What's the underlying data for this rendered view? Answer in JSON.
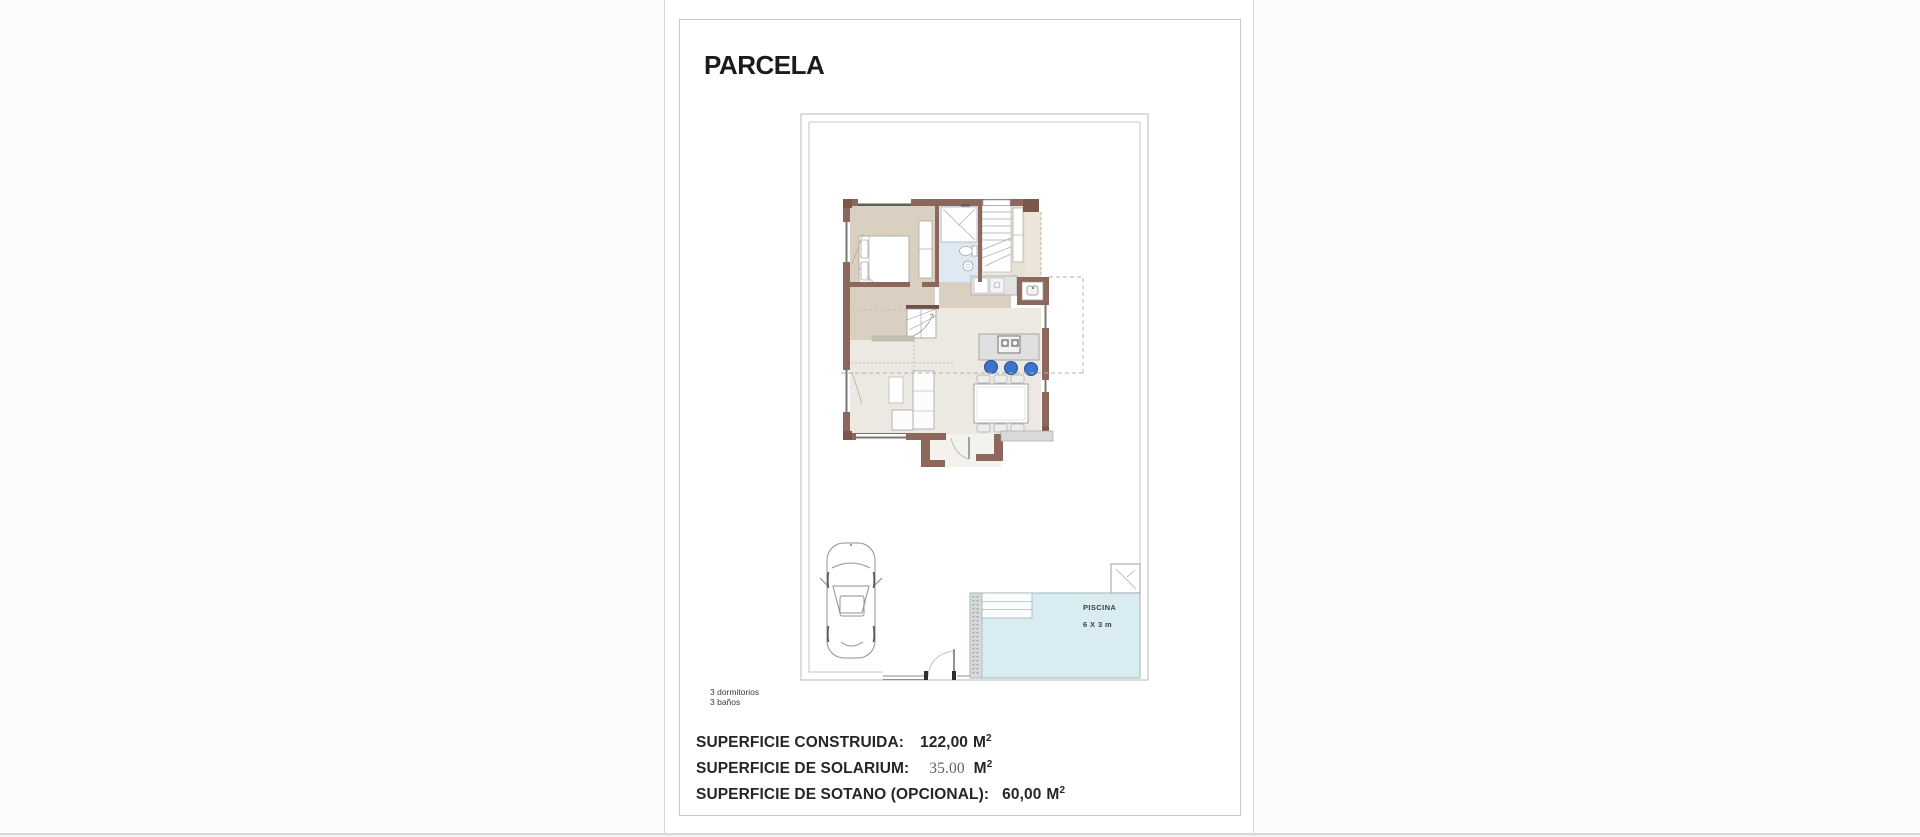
{
  "document": {
    "title": "PARCELA",
    "notes": [
      "3 dormitorios",
      "3 baños"
    ],
    "summary": [
      {
        "label": "SUPERFICIE CONSTRUIDA:",
        "value": "122,00",
        "unit": "M",
        "exp": "2"
      },
      {
        "label": "SUPERFICIE DE SOLARIUM:",
        "value": "35.00",
        "unit": "M",
        "exp": "2"
      },
      {
        "label": "SUPERFICIE DE SOTANO (OPCIONAL):",
        "value": "60,00",
        "unit": "M",
        "exp": "2"
      }
    ],
    "plan": {
      "pool": {
        "label": "PISCINA",
        "size": "6 X 3 m"
      }
    },
    "colors": {
      "wall_brown": "#8d675b",
      "wall_dark": "#7a584c",
      "floor_beige": "#d9d0c2",
      "floor_light": "#ece9e2",
      "bathroom_blue": "#dfe9f1",
      "pool_blue": "#d9ecf2",
      "stool_blue": "#3b74c9",
      "boundary_gray": "#b9b9b9"
    }
  }
}
